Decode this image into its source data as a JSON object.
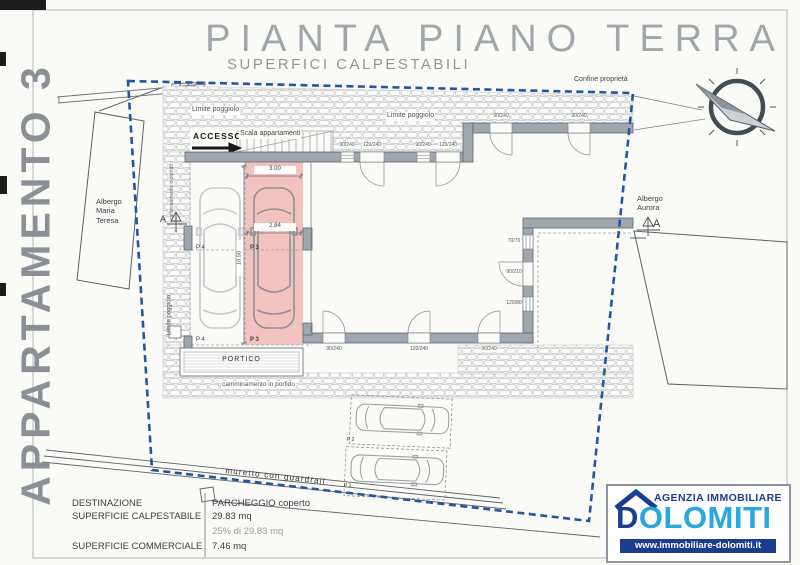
{
  "page": {
    "title": "PIANTA PIANO TERRA",
    "subtitle": "SUPERFICI CALPESTABILI",
    "side_label": "APPARTAMENTO 3",
    "section_mark": "A"
  },
  "plan": {
    "confine": "Confine proprietà",
    "maria_teresa": [
      "Albergo",
      "Maria",
      "Teresa"
    ],
    "aurora": [
      "Albergo",
      "Aurora"
    ],
    "limite_poggiolo": "Limite poggiolo",
    "accesso": "ACCESSO",
    "scala": "Scala appartamenti",
    "camminamento": "camminamento in porfido",
    "portico": "PORTICO",
    "muretto": "muretto con guardrail",
    "p1": "P 1",
    "p2": "P 2",
    "p3": "P 3",
    "p4": "P 4",
    "dim_width_top": "3.00",
    "dim_width": "2.84",
    "dim_depth": "10.50",
    "opening_dims": [
      "90/240",
      "120/240",
      "90/240",
      "120/240",
      "90/240",
      "90/240",
      "90/240",
      "120/240",
      "90/240",
      "70/70",
      "90/210",
      "120/80"
    ]
  },
  "legend": {
    "destinazione_label": "DESTINAZIONE",
    "destinazione_value": "PARCHEGGIO coperto",
    "calpestabile_label": "SUPERFICIE CALPESTABILE",
    "calpestabile_value": "29.83 mq",
    "percent_note": "25% di 29.83 mq",
    "commerciale_label": "SUPERFICIE COMMERCIALE",
    "commerciale_value": "7.46 mq"
  },
  "logo": {
    "agency": "AGENZIA IMMOBILIARE",
    "name_d": "D",
    "name_rest": "OLOMITI",
    "website": "www.immobiliare-dolomiti.it"
  },
  "colors": {
    "boundary_blue": "#24569f",
    "apartment_pink": "#f0b4b0",
    "wall_gray": "#9fa7ae",
    "logo_dark": "#1b3d91",
    "logo_light": "#29a8e0"
  }
}
